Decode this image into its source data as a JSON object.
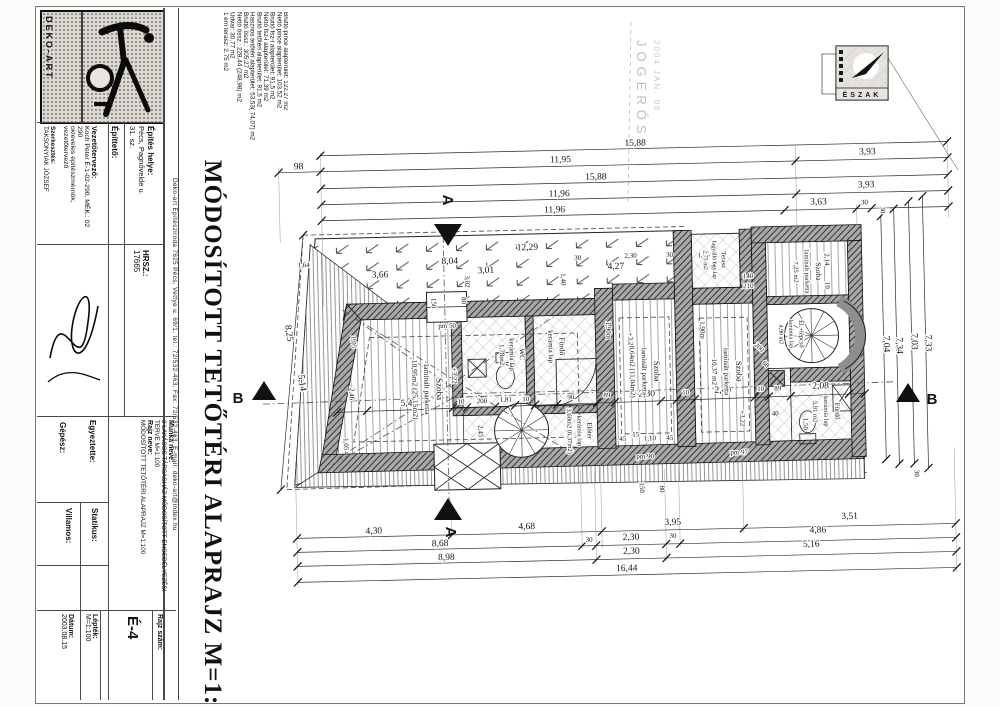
{
  "titleblock": {
    "logo_name": "DEKO-ART",
    "firm_strip": "Deko-art Építésziroda 7625 Pécs, Vettye u. 69/1, tel.: 72/532-463, Fax: 72/532-463, E-mail: deko-art@index.hu",
    "vezetotervezo": {
      "label": "Vezetőtervező:",
      "line1": "Koch Péter É-1-02-290, MÉK.: 02 290",
      "line2": "okleveles építészmérnök, vezetőtervező"
    },
    "szerkesztes": {
      "label": "Szerkesztés:",
      "value": "TAKSONYIAK JÓZSEF"
    },
    "epitteto_label": "Építtető:",
    "epites_helye": {
      "label": "Építés helye:",
      "line1": "Pécs, Pagnővelde u.",
      "line2": "31. sz."
    },
    "hrsz": {
      "label": "HRSZ.:",
      "value": "17665"
    },
    "gepesz_label": "Gépész:",
    "egyeztette_label": "Egyeztette:",
    "villamos_label": "Villamos:",
    "statikus_label": "Statikus:",
    "munka_neve": {
      "label": "Munka neve:",
      "value": "2 LAKÁSOS TÁRSASHÁZ MÓDOSÍTOTT ENGEDÉLYEZÉSI TERVE M=1:100"
    },
    "rajz_neve": {
      "label": "Rajz neve:",
      "value": "MÓDOSÍTOTT TETŐTÉRI ALAPRAJZ M=1:100"
    },
    "datum": {
      "label": "Dátum:",
      "value": "2003.08.15"
    },
    "leptek": {
      "label": "Lépték:",
      "value": "M=1:100"
    },
    "rajz_szam": {
      "label": "Rajz szám:",
      "value": "É-4"
    },
    "main_title": "MÓDOSÍTOTT TETŐTÉRI ALAPRAJZ M=1:100"
  },
  "stats": {
    "lines": [
      "Bruttó pince alapterület: 122,27 m2",
      "Nettó pince alapterület: 103,52 m2",
      "Bruttó fsz-i alapterület: 91,5 m2",
      "Nettó fsz-i alapterület: 71,39 m2",
      "Bruttó tetőtéri alapterület: 91,5 m2",
      "Hasznos tetőtéri alapterület: 53,53( 74,07) m2",
      "Bruttó össz.: 305,27 m2",
      "Nettó össz.: 228,44 (248,98) m2",
      "Udvar: 30,77 m2",
      "1 em terasz: 2,75 m2",
      "Beépített%: 75%"
    ]
  },
  "stamp": {
    "line1": "JOGERŐS",
    "line2": "2004 JAN. 06."
  },
  "north_label": "ÉSZAK",
  "watermark_text": "OSS",
  "plan": {
    "level": "+3,22",
    "sections": {
      "a": "A",
      "b": "B"
    },
    "rooms": [
      {
        "id": "szoba1",
        "lines": [
          "Szoba",
          "laminált parketta",
          "10,95m2 (25,15m2)"
        ]
      },
      {
        "id": "wc",
        "lines": [
          "WC",
          "kerámia lap",
          "1,78m2"
        ]
      },
      {
        "id": "furdo1",
        "lines": [
          "Fürdő",
          "kerámia lap"
        ]
      },
      {
        "id": "eloter",
        "lines": [
          "Előtér",
          "kerámia lap",
          "3,60m2 (6,37m2)"
        ]
      },
      {
        "id": "szoba2",
        "lines": [
          "Szoba",
          "laminált parketta",
          "8,64m2 (11,04m2)"
        ]
      },
      {
        "id": "szoba3",
        "lines": [
          "Szoba",
          "laminált parketta",
          "10,37 m2"
        ]
      },
      {
        "id": "terasz",
        "lines": [
          "Terasz",
          "fagyálló bgy.lap",
          "2,75 m2"
        ]
      },
      {
        "id": "szoba4",
        "lines": [
          "Szoba",
          "laminált parketta",
          "7,25 m2"
        ]
      },
      {
        "id": "lepcso",
        "lines": [
          "Él.+lépcső",
          "kerámia lap",
          "4,90 m2"
        ]
      },
      {
        "id": "furdo2",
        "lines": [
          "Fürdő",
          "kerámia lap",
          "5,91 m2"
        ]
      }
    ],
    "dims": {
      "top": [
        "15,88",
        "98",
        "11,95",
        "3,93",
        "15,88",
        "11,96",
        "3,93",
        "11,96",
        "3,63",
        "30"
      ],
      "bottom": [
        "4,30",
        "4,68",
        "3,95",
        "3,51",
        "8,68",
        "30",
        "2,30",
        "30",
        "4,86",
        "8,98",
        "2,30",
        "5,16",
        "16,44"
      ],
      "right": [
        "7,04",
        "7,34",
        "7,03",
        "7,33",
        "30",
        "30"
      ],
      "left": [
        "8,25",
        "5,14",
        "1,64"
      ],
      "inner_top": [
        "12,29",
        "8,04",
        "30",
        "2,30",
        "30",
        "1,35",
        "3,66",
        "3,01",
        "4,27",
        "3,02",
        "1,40",
        "140",
        "210",
        "2,14",
        "10"
      ],
      "mid": [
        "2,46",
        "1,05",
        "1,05",
        "5,43",
        "10",
        "200",
        "1,81",
        "10",
        "90",
        "89",
        "2,30",
        "10",
        "2,40",
        "10",
        "89",
        "2,08"
      ],
      "small": [
        "pm 50",
        "pm 90",
        "pm 97",
        "150",
        "80",
        "45",
        "15",
        "1,10",
        "45",
        "1,50",
        "40",
        "200",
        "68",
        "1,90m",
        "1,90m",
        "2,45",
        "150",
        "80"
      ]
    }
  }
}
